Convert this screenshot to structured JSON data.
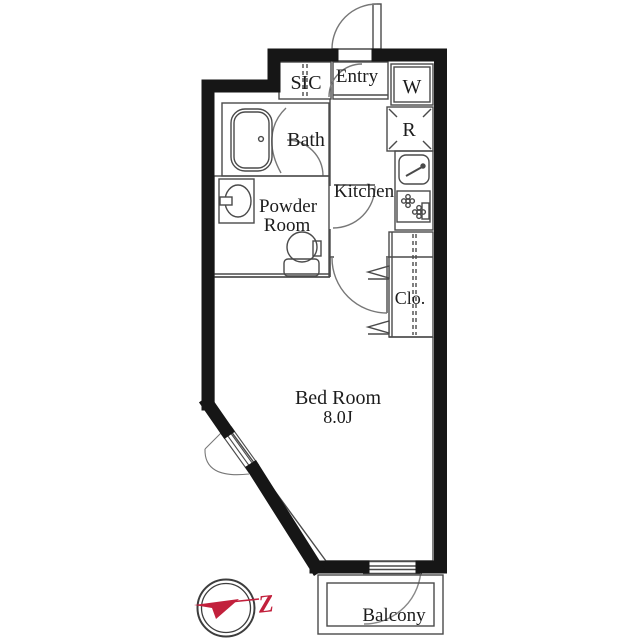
{
  "plan": {
    "rooms": {
      "sic": "SIC",
      "entry": "Entry",
      "washer": "W",
      "fridge": "R",
      "bath": "Bath",
      "powder_line1": "Powder",
      "powder_line2": "Room",
      "kitchen": "Kitchen",
      "closet": "Clo.",
      "bedroom_name": "Bed Room",
      "bedroom_size": "8.0J",
      "balcony": "Balcony"
    },
    "compass": {
      "north_letter": "Z"
    },
    "colors": {
      "wall": "#161616",
      "thin_line": "#4a4a4a",
      "accent_red": "#c2203c"
    }
  }
}
